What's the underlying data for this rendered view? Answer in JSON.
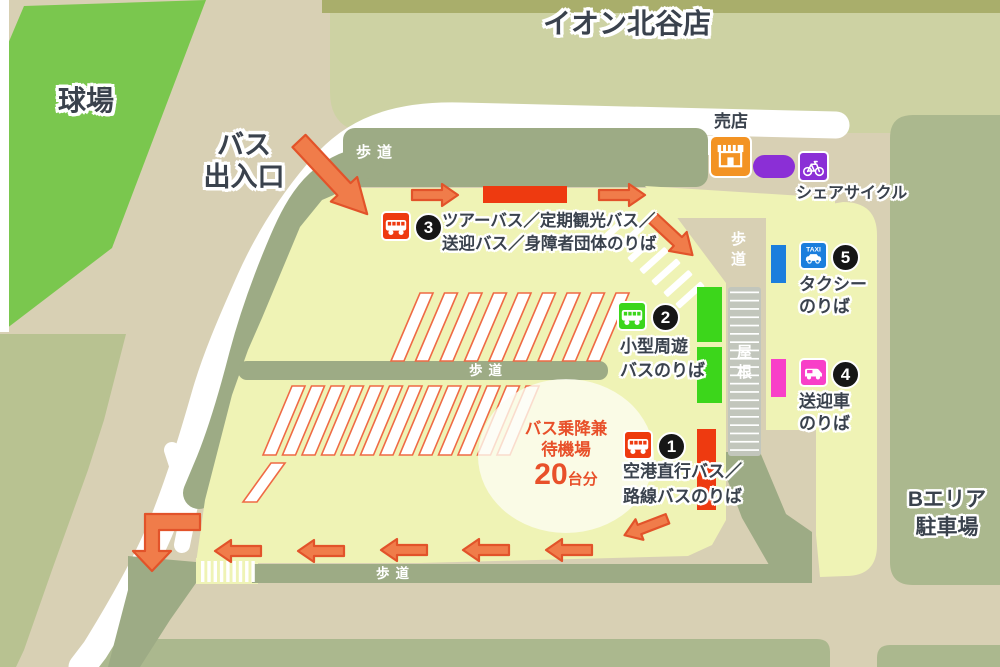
{
  "title": "イオン北谷店",
  "labels": {
    "stadium": "球場",
    "bus_gate_line1": "バス",
    "bus_gate_line2": "出入口",
    "sidewalk": "歩道",
    "roof": "屋根",
    "shop": "売店",
    "share_cycle": "シェアサイクル",
    "b_area_line1": "Bエリア",
    "b_area_line2": "駐車場"
  },
  "stops": [
    {
      "no": "1",
      "lines": [
        "空港直行バス／",
        "路線バスのりば"
      ],
      "color": "#ee3a10",
      "icon": "bus"
    },
    {
      "no": "2",
      "lines": [
        "小型周遊",
        "バスのりば"
      ],
      "color": "#3cd61b",
      "icon": "bus"
    },
    {
      "no": "3",
      "lines": [
        "ツアーバス／定期観光バス／",
        "送迎バス／身障者団体のりば"
      ],
      "color": "#ee3a10",
      "icon": "bus"
    },
    {
      "no": "4",
      "lines": [
        "送迎車",
        "のりば"
      ],
      "color": "#f83fc8",
      "icon": "shuttle-car"
    },
    {
      "no": "5",
      "lines": [
        "タクシー",
        "のりば"
      ],
      "color": "#1b7edd",
      "icon": "taxi",
      "sign": "TAXI"
    }
  ],
  "waiting_area": {
    "lines": [
      "バス乗降兼",
      "待機場"
    ],
    "count": "20",
    "unit": "台分"
  },
  "colors": {
    "stop_red": "#ee3a10",
    "stop_green": "#3cd61b",
    "taxi_blue": "#1b7edd",
    "shuttle_pink": "#f83fc8",
    "cycle_purple": "#8b2fd6",
    "shop_orange": "#f39323",
    "arrow_orange": "#f07c4a",
    "terminal_yellow": "#eff3b5",
    "stadium_green": "#7ac74e",
    "note_red": "#e8502a"
  }
}
